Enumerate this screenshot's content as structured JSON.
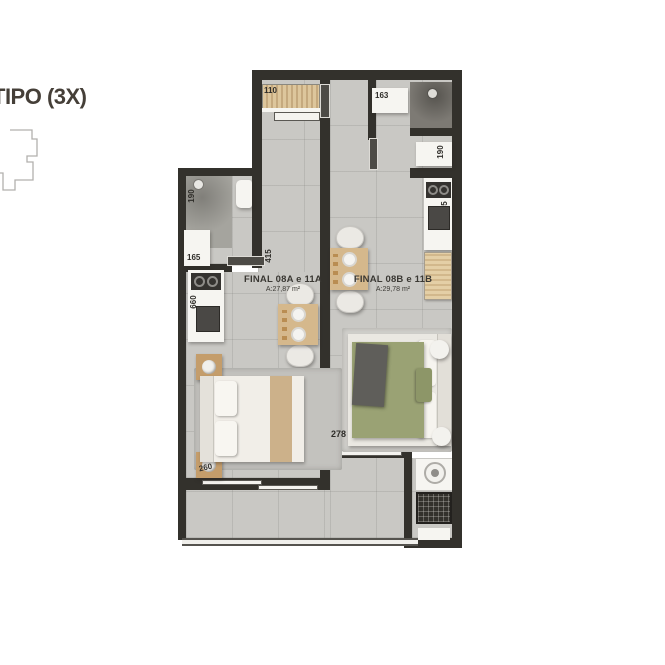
{
  "title": "TIPO (3X)",
  "units": {
    "a": {
      "name": "FINAL 08A e 11A",
      "area": "A:27,87 m²"
    },
    "b": {
      "name": "FINAL 08B e 11B",
      "area": "A:29,78 m²"
    }
  },
  "dimensions": {
    "closet_a": "110",
    "bath_b": "163",
    "bench_b": "190",
    "shower_a": "190",
    "vanity_a": "165",
    "kitchen_b": "605",
    "kitchen_a": "660",
    "bath_a_door": "415",
    "nightstand_a": "260",
    "bed_b": "278"
  },
  "colors": {
    "wall": "#33312c",
    "floor": "#c9c8c4",
    "wood": "#d5b88c",
    "bed_green": "#9aa274",
    "title_text": "#453f38"
  }
}
